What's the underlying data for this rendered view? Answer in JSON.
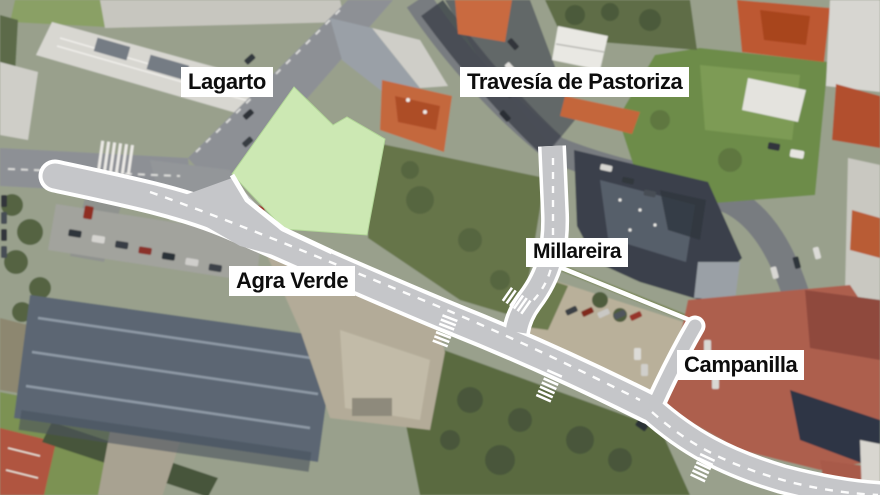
{
  "map": {
    "type": "satellite-annotated-street-map",
    "street_labels": [
      {
        "id": "lagarto",
        "text": "Lagarto"
      },
      {
        "id": "travesia-de-pastoriza",
        "text": "Travesía de Pastoriza"
      },
      {
        "id": "agra-verde",
        "text": "Agra Verde"
      },
      {
        "id": "millareira",
        "text": "Millareira"
      },
      {
        "id": "campanilla",
        "text": "Campanilla"
      }
    ],
    "colors": {
      "highlighted_road_fill": "#c5c6c9",
      "road_edge": "#ffffff",
      "highlighted_plot_fill": "#cce8b3",
      "label_background": "#ffffff",
      "label_text": "#0d0d0d"
    }
  }
}
